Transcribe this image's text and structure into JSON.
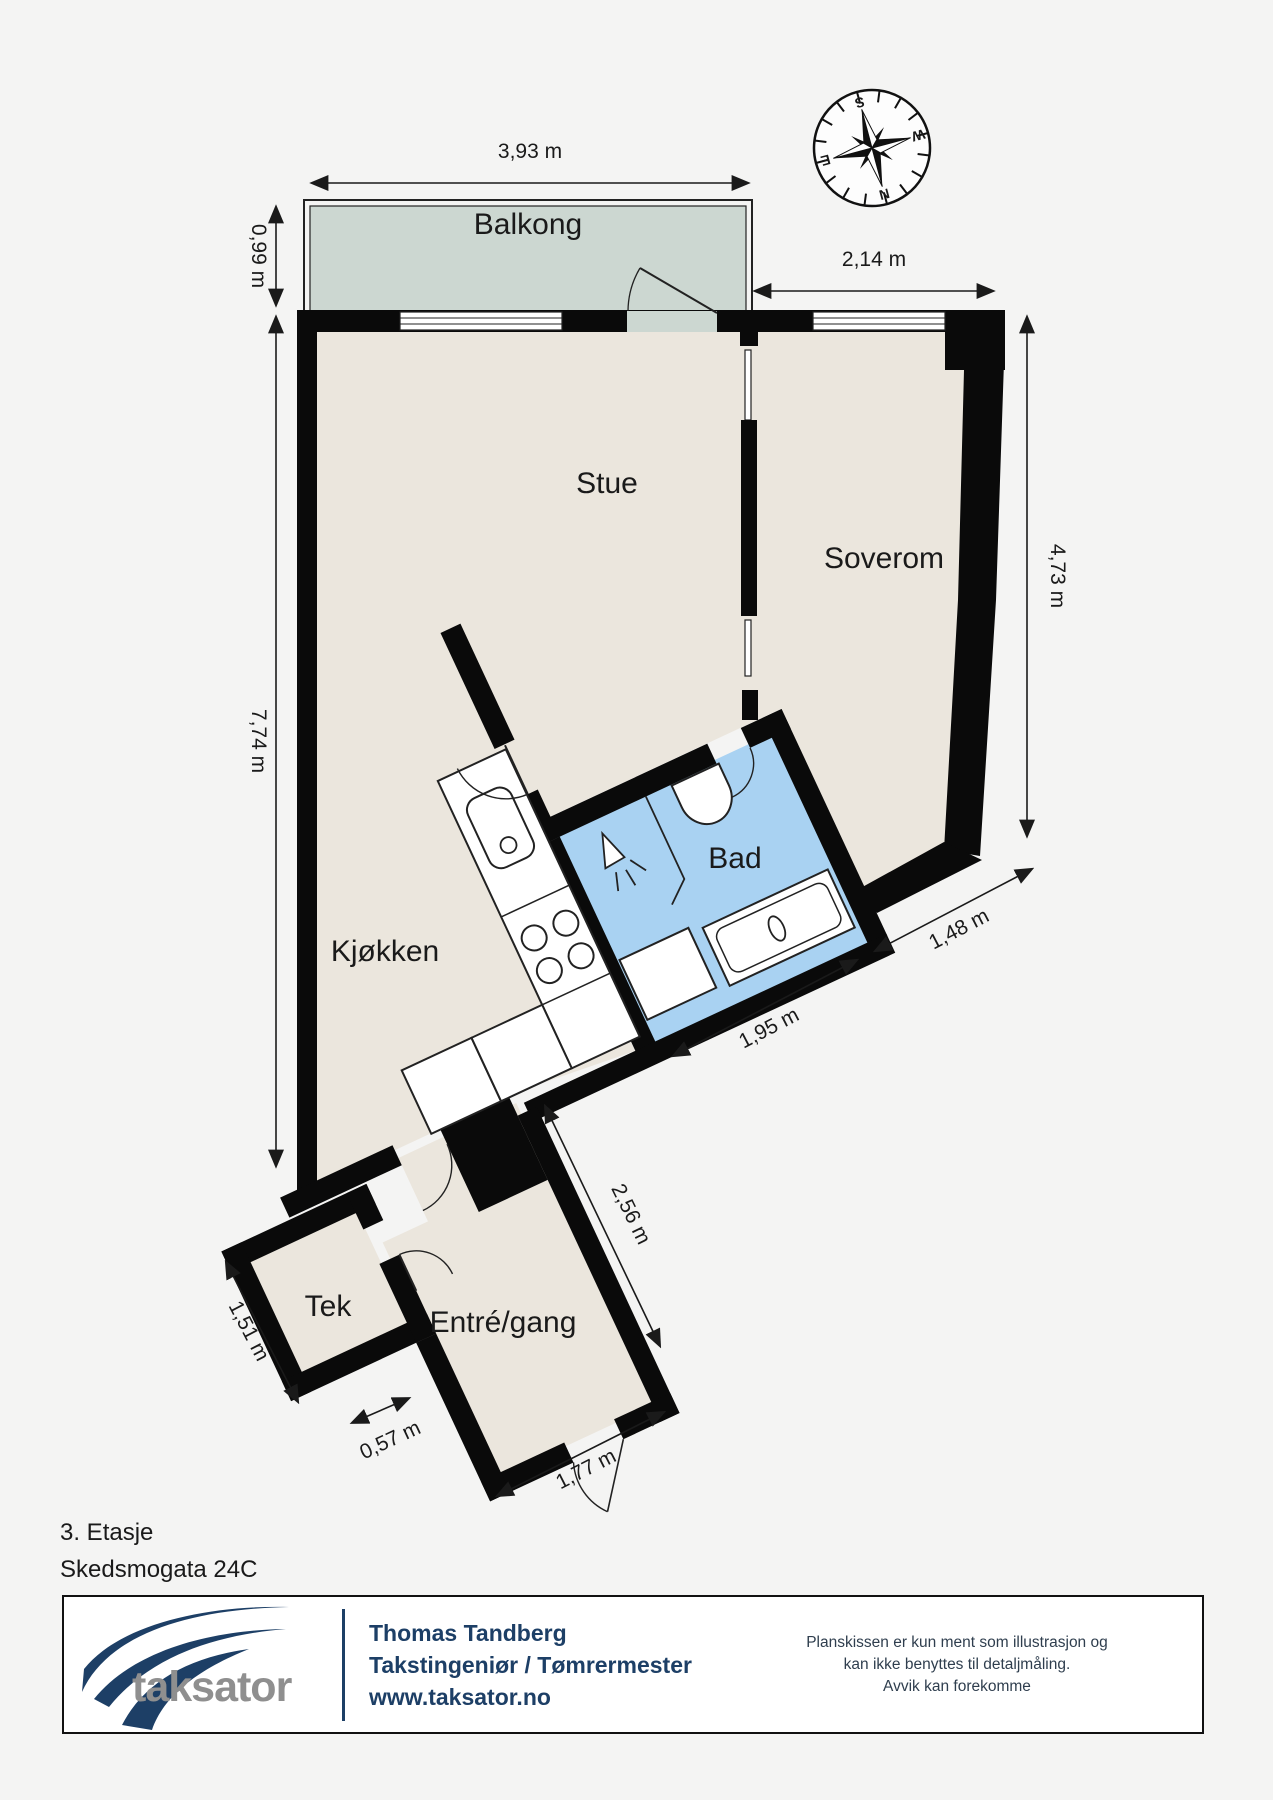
{
  "title": {
    "floor": "3. Etasje",
    "address": "Skedsmogata 24C"
  },
  "rooms": {
    "balcony": "Balkong",
    "living": "Stue",
    "bedroom": "Soverom",
    "kitchen": "Kjøkken",
    "bath": "Bad",
    "tech": "Tek",
    "entry": "Entré/gang"
  },
  "dimensions": {
    "balcony_width": "3,93 m",
    "balcony_depth": "0,99 m",
    "bedroom_top": "2,14 m",
    "bedroom_right": "4,73 m",
    "left_height": "7,74 m",
    "bath_bottom": "1,95 m",
    "bedroom_diagonal": "1,48 m",
    "hall_right": "2,56 m",
    "tech_left": "1,51 m",
    "tech_bottom": "0,57 m",
    "entry_bottom": "1,77 m"
  },
  "compass": {
    "n": "N",
    "s": "S",
    "e": "E",
    "w": "W"
  },
  "footer": {
    "logo": "taksator",
    "name": "Thomas Tandberg",
    "role": "Takstingeniør / Tømrermester",
    "web": "www.taksator.no",
    "disclaimer": [
      "Planskissen er kun ment som illustrasjon og",
      "kan ikke benyttes til detaljmåling.",
      "Avvik kan forekomme"
    ]
  },
  "colors": {
    "background": "#f4f4f3",
    "floor": "#ebe6dd",
    "balcony_floor": "#ccd7d1",
    "bath_floor": "#a9d2f2",
    "wall": "#0a0a0a",
    "brand_navy": "#1d3f66",
    "brand_gray": "#8f8f8f"
  }
}
